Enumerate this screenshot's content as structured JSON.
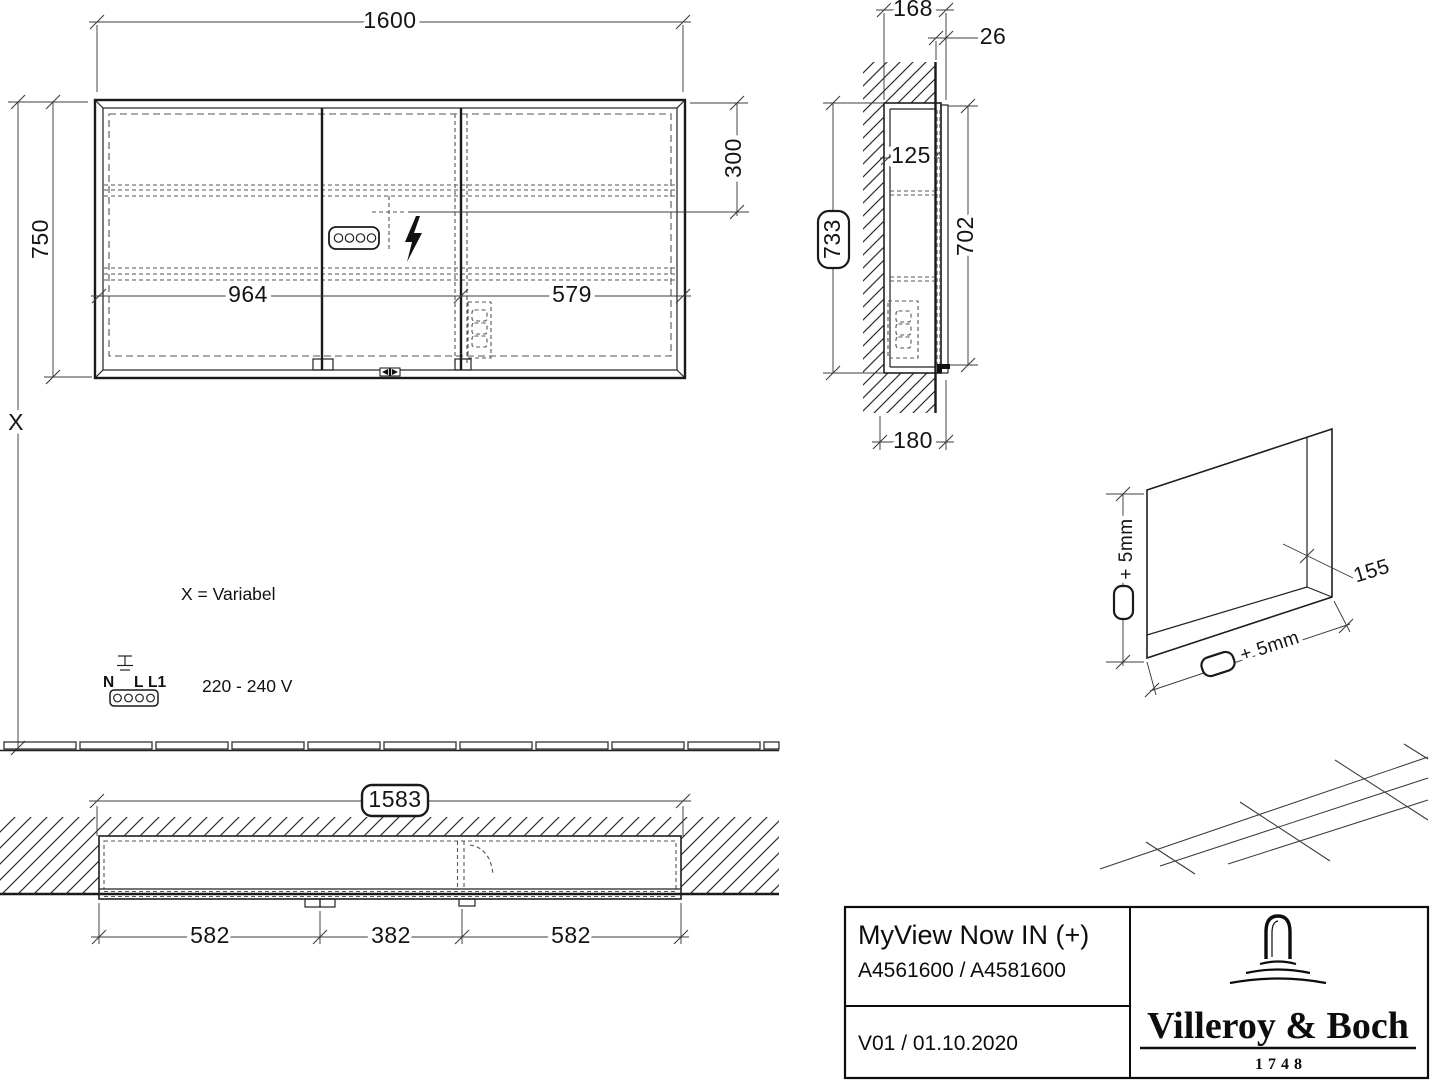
{
  "front_view": {
    "width": "1600",
    "height": "750",
    "variable_height": "X",
    "socket_offset": "300",
    "left_width": "964",
    "right_width": "579"
  },
  "side_view": {
    "top_depth": "168",
    "overhang": "26",
    "inner_depth": "125",
    "niche_height": "733",
    "body_height": "702",
    "bottom_depth": "180"
  },
  "plan_view": {
    "niche_width": "1583",
    "left": "582",
    "center": "382",
    "right": "582"
  },
  "niche_view": {
    "height_tolerance": "+ 5mm",
    "width_tolerance": "+ 5mm",
    "depth": "155"
  },
  "notes": {
    "variable_note": "X = Variabel",
    "voltage": "220 - 240 V",
    "terminal_n": "N",
    "terminal_l": "L",
    "terminal_l1": "L1"
  },
  "title_block": {
    "product_name": "MyView Now IN (+)",
    "article_numbers": "A4561600 / A4581600",
    "version_date": "V01 / 01.10.2020",
    "brand_name": "Villeroy & Boch",
    "brand_year": "1748"
  },
  "colors": {
    "line": "#1c1c1c",
    "dim": "#3c3c3c",
    "dashed": "#555555",
    "background": "#ffffff"
  }
}
